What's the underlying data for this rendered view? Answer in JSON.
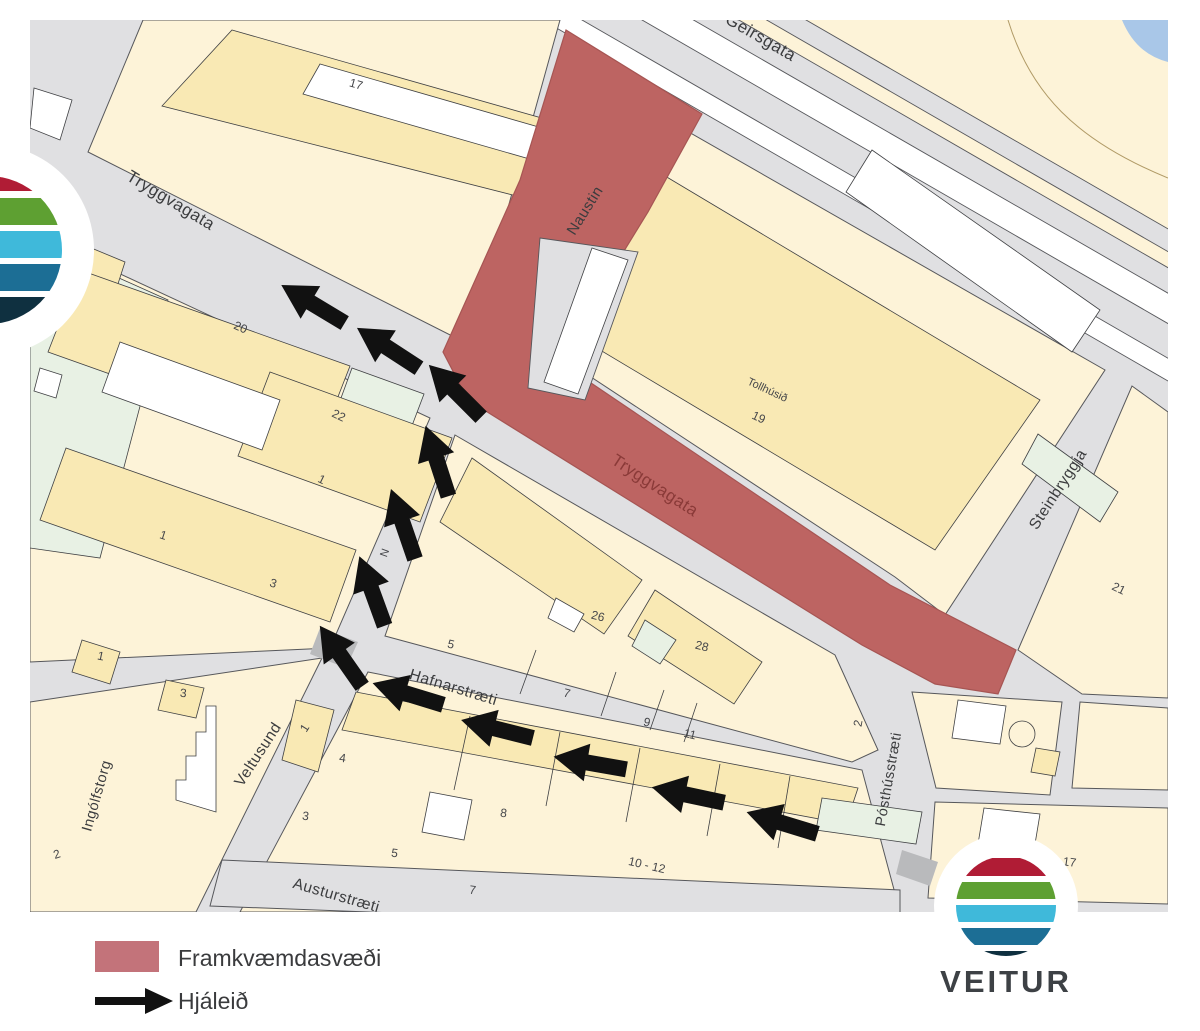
{
  "colors": {
    "construction": "#bd6462",
    "construction_edge": "#a65553",
    "legend_swatch": "#c3737a",
    "street": "#e0e0e2",
    "street_dark": "#b9babc",
    "lot": "#fdf3d8",
    "building": "#f9e9b4",
    "green": "#e8f1e4",
    "white_building": "#ffffff",
    "water": "#a9c7e8",
    "arrow": "#111111",
    "logo_stripes": [
      "#b01c35",
      "#5ea032",
      "#3fb9da",
      "#1c6e95",
      "#0f3040"
    ],
    "logo_text": "#3d4145"
  },
  "legend": {
    "construction_label": "Framkvæmdasvæði",
    "detour_label": "Hjáleið"
  },
  "logo": {
    "text": "VEITUR"
  },
  "street_labels": [
    {
      "text": "Geirsgata",
      "x": 758,
      "y": 42,
      "rot": 30,
      "size": 17
    },
    {
      "text": "Tryggvagata",
      "x": 168,
      "y": 205,
      "rot": 31,
      "size": 17
    },
    {
      "text": "Naustin",
      "x": 589,
      "y": 213,
      "rot": -58,
      "size": 15
    },
    {
      "text": "Tryggvagata",
      "x": 652,
      "y": 490,
      "rot": 33,
      "size": 17,
      "red": true
    },
    {
      "text": "Steinbryggja",
      "x": 1062,
      "y": 492,
      "rot": -57,
      "size": 15.5
    },
    {
      "text": "Hafnarstræti",
      "x": 452,
      "y": 692,
      "rot": 17,
      "size": 15.5
    },
    {
      "text": "Pósthússtræti",
      "x": 893,
      "y": 780,
      "rot": -80,
      "size": 14.5
    },
    {
      "text": "Veltusund",
      "x": 262,
      "y": 757,
      "rot": -57,
      "size": 15.5
    },
    {
      "text": "Ingólfstorg",
      "x": 101,
      "y": 797,
      "rot": -74,
      "size": 14.5
    },
    {
      "text": "Austurstræti",
      "x": 335,
      "y": 900,
      "rot": 16,
      "size": 15.5
    }
  ],
  "building_labels": [
    {
      "text": "17",
      "x": 355,
      "y": 88,
      "rot": 16
    },
    {
      "text": "20",
      "x": 239,
      "y": 331,
      "rot": 24
    },
    {
      "text": "22",
      "x": 337,
      "y": 419,
      "rot": 26
    },
    {
      "text": "1",
      "x": 320,
      "y": 483,
      "rot": 26
    },
    {
      "text": "1",
      "x": 162,
      "y": 539,
      "rot": 18
    },
    {
      "text": "3",
      "x": 272,
      "y": 587,
      "rot": 18
    },
    {
      "text": "1",
      "x": 100,
      "y": 660,
      "rot": 12
    },
    {
      "text": "3",
      "x": 183,
      "y": 697,
      "rot": 5
    },
    {
      "text": "2",
      "x": 58,
      "y": 858,
      "rot": -18
    },
    {
      "text": "Tollhúsið",
      "x": 766,
      "y": 393,
      "rot": 25,
      "size": 11
    },
    {
      "text": "19",
      "x": 757,
      "y": 421,
      "rot": 25
    },
    {
      "text": "21",
      "x": 1117,
      "y": 592,
      "rot": 26
    },
    {
      "text": "26",
      "x": 597,
      "y": 620,
      "rot": 14
    },
    {
      "text": "28",
      "x": 701,
      "y": 650,
      "rot": 14
    },
    {
      "text": "5",
      "x": 450,
      "y": 648,
      "rot": 14
    },
    {
      "text": "7",
      "x": 566,
      "y": 697,
      "rot": 14
    },
    {
      "text": "9",
      "x": 646,
      "y": 726,
      "rot": 14
    },
    {
      "text": "11",
      "x": 689,
      "y": 738,
      "rot": 14
    },
    {
      "text": "N",
      "x": 388,
      "y": 554,
      "rot": -70,
      "size": 11
    },
    {
      "text": "1",
      "x": 308,
      "y": 730,
      "rot": -58
    },
    {
      "text": "4",
      "x": 342,
      "y": 762,
      "rot": 8
    },
    {
      "text": "3",
      "x": 305,
      "y": 820,
      "rot": 8
    },
    {
      "text": "8",
      "x": 503,
      "y": 817,
      "rot": 8
    },
    {
      "text": "5",
      "x": 394,
      "y": 857,
      "rot": 8
    },
    {
      "text": "7",
      "x": 472,
      "y": 894,
      "rot": 8
    },
    {
      "text": "10 - 12",
      "x": 646,
      "y": 869,
      "rot": 13
    },
    {
      "text": "2",
      "x": 862,
      "y": 724,
      "rot": -80
    },
    {
      "text": "15",
      "x": 1016,
      "y": 847,
      "rot": 8
    },
    {
      "text": "17",
      "x": 1069,
      "y": 866,
      "rot": 8
    }
  ],
  "arrows": [
    {
      "x": 782,
      "y": 823,
      "rot": 197
    },
    {
      "x": 688,
      "y": 795,
      "rot": 192
    },
    {
      "x": 590,
      "y": 763,
      "rot": 190
    },
    {
      "x": 497,
      "y": 729,
      "rot": 194
    },
    {
      "x": 408,
      "y": 694,
      "rot": 197
    },
    {
      "x": 341,
      "y": 656,
      "rot": 235
    },
    {
      "x": 372,
      "y": 591,
      "rot": 250
    },
    {
      "x": 403,
      "y": 524,
      "rot": 251
    },
    {
      "x": 437,
      "y": 461,
      "rot": 252
    },
    {
      "x": 455,
      "y": 391,
      "rot": 225
    },
    {
      "x": 388,
      "y": 348,
      "rot": 213
    },
    {
      "x": 313,
      "y": 304,
      "rot": 211
    }
  ]
}
